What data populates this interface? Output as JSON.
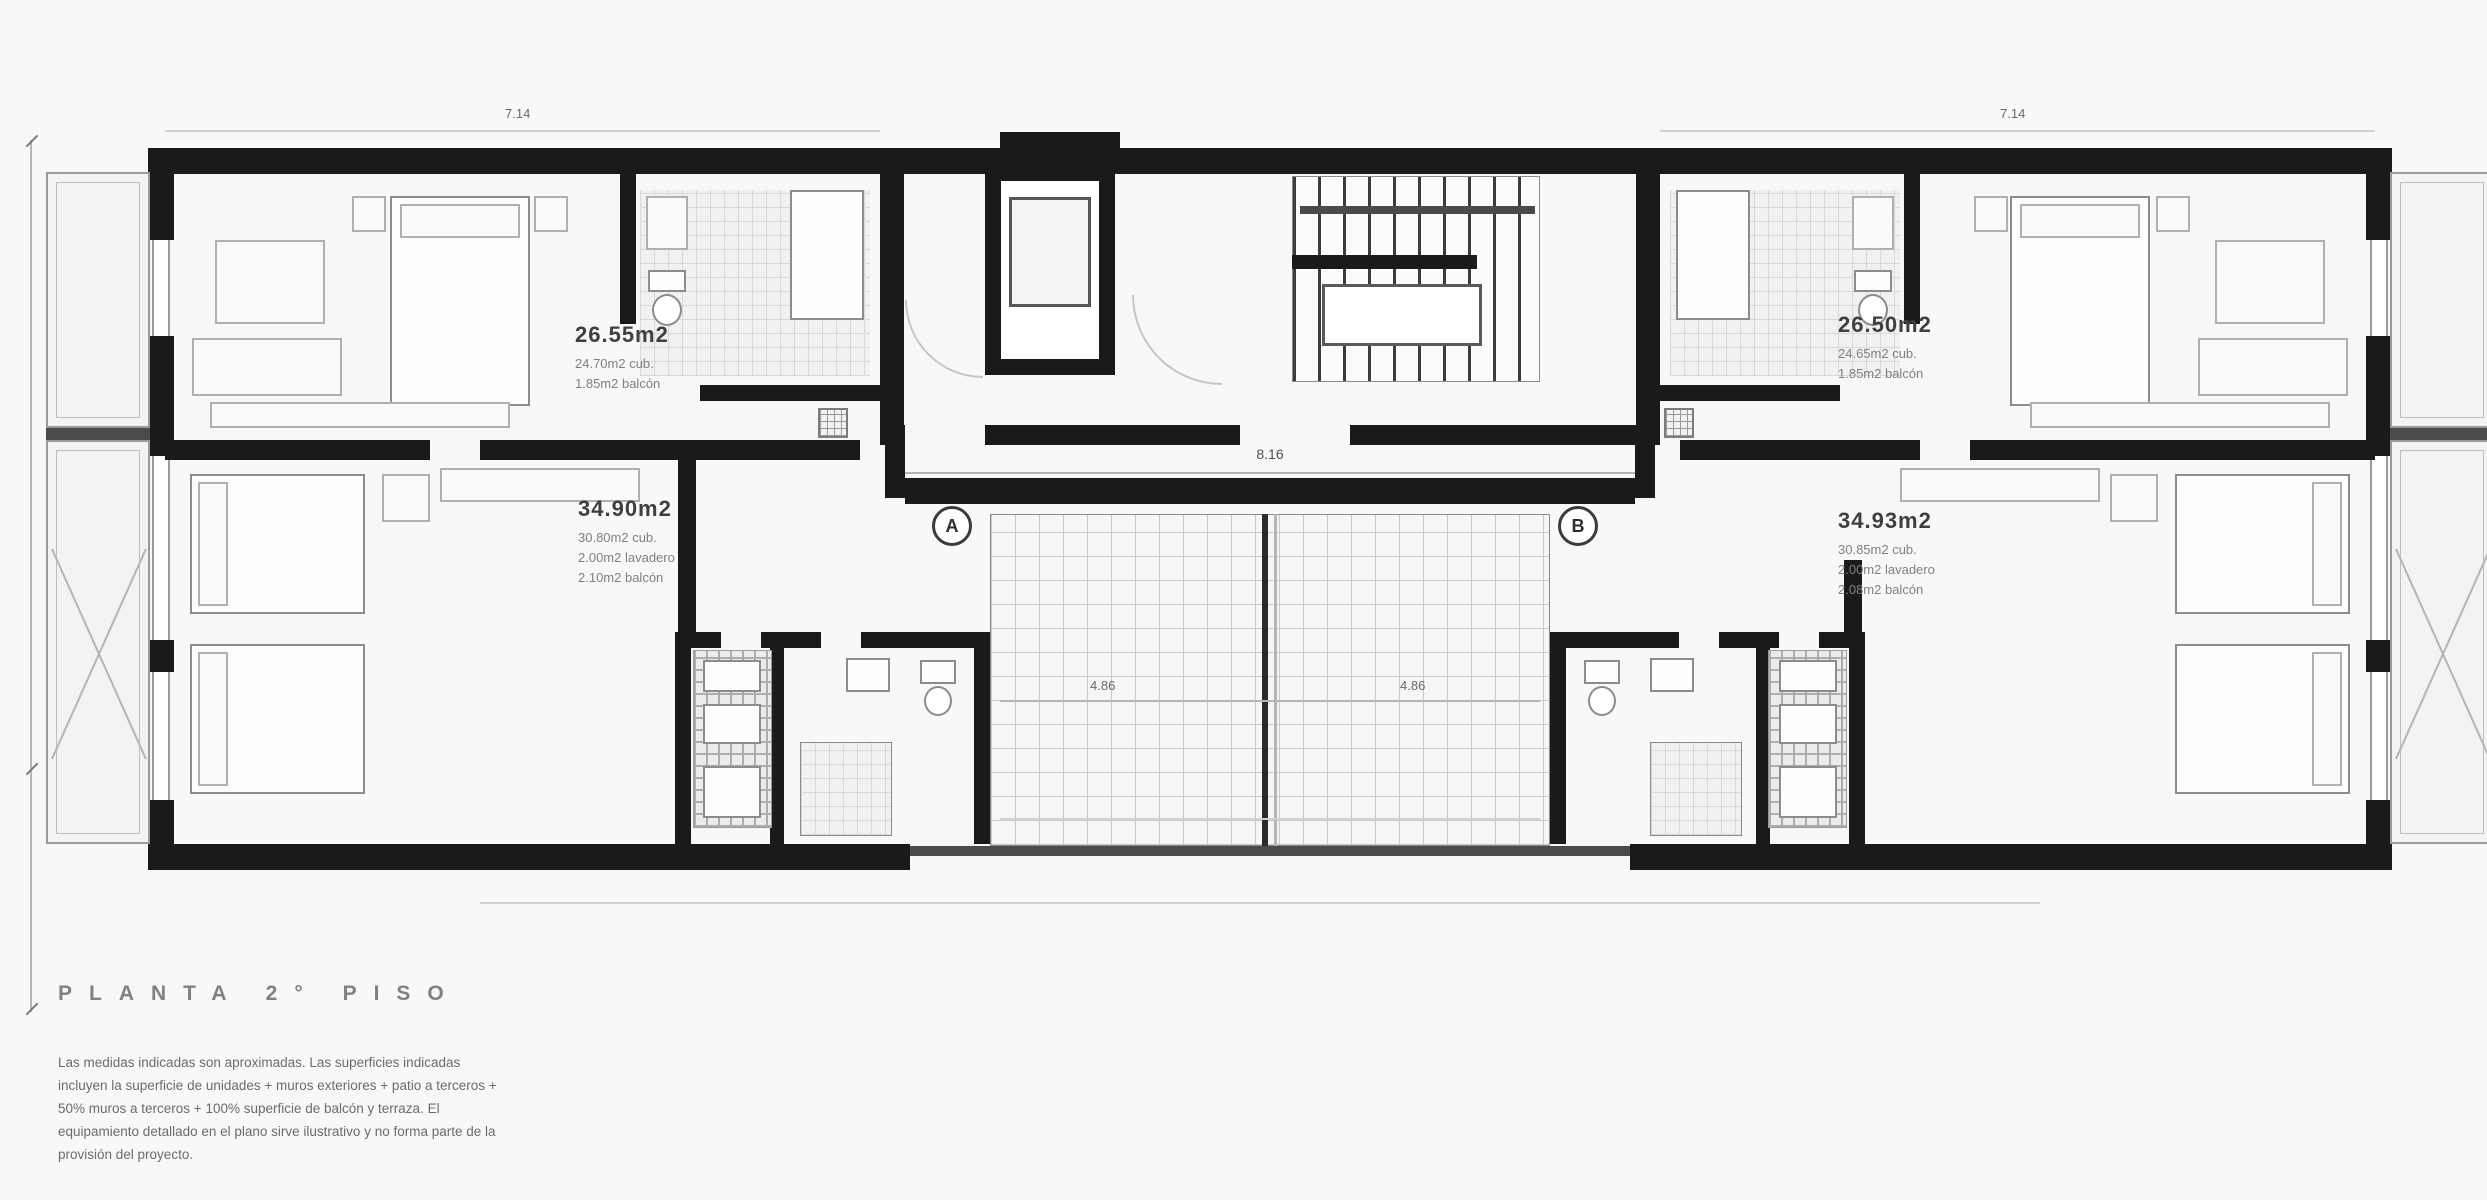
{
  "title": {
    "label": "PLANTA 2° PISO"
  },
  "notes": {
    "lines": [
      "Las medidas indicadas son aproximadas. Las superficies indicadas",
      "incluyen la superficie de unidades + muros exteriores + patio a terceros +",
      "50% muros a terceros + 100% superficie de balcón y terraza. El",
      "equipamiento detallado en el plano sirve ilustrativo y no forma parte de la",
      "provisión del proyecto."
    ]
  },
  "units": {
    "top_left": {
      "area": "26.55m2",
      "details": [
        "24.70m2 cub.",
        "1.85m2 balcón"
      ]
    },
    "top_right": {
      "area": "26.50m2",
      "details": [
        "24.65m2 cub.",
        "1.85m2 balcón"
      ]
    },
    "bottom_left": {
      "area": "34.90m2",
      "details": [
        "30.80m2 cub.",
        "2.00m2 lavadero",
        "2.10m2 balcón"
      ]
    },
    "bottom_right": {
      "area": "34.93m2",
      "details": [
        "30.85m2 cub.",
        "2.00m2 lavadero",
        "2.08m2 balcón"
      ]
    }
  },
  "dimensions": {
    "corridor": "8.16",
    "patio_left": "4.86",
    "patio_right": "4.86",
    "unit_top_left": "7.14",
    "unit_top_right": "7.14"
  },
  "markers": {
    "section_a": "A",
    "section_b": "B"
  },
  "colors": {
    "wall": "#1a1a1a",
    "line": "#b5b5b5",
    "text": "#6b6b6b"
  }
}
